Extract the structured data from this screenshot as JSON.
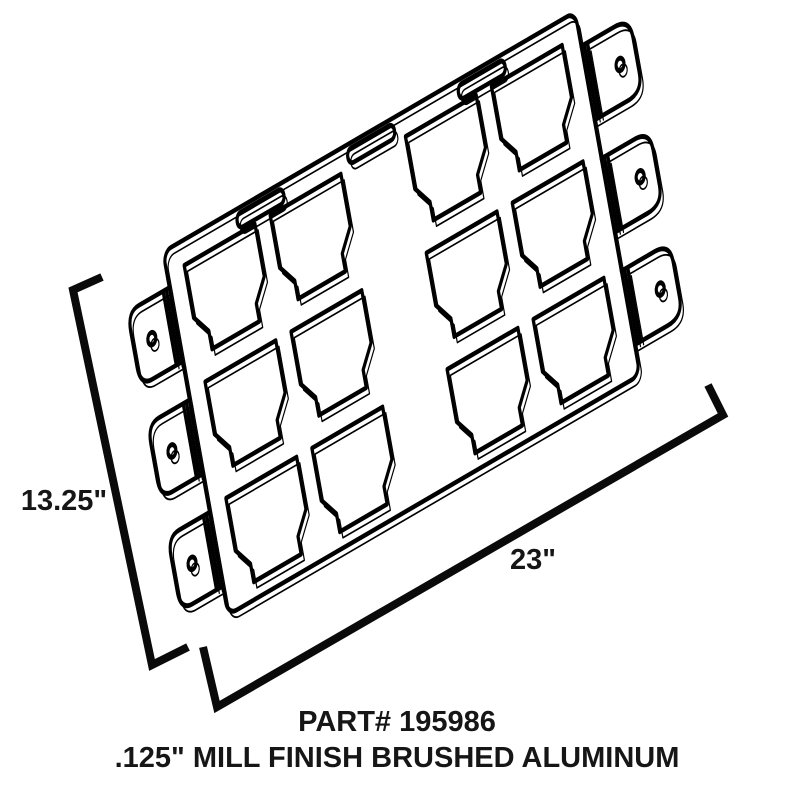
{
  "drawing": {
    "type": "technical-line-drawing",
    "part_label": "PART# 195986",
    "material_label": ".125\" MILL FINISH BRUSHED ALUMINUM",
    "dimensions": {
      "height_label": "13.25\"",
      "width_label": "23\""
    },
    "colors": {
      "background": "#ffffff",
      "line": "#000000",
      "text": "#161616"
    },
    "features": {
      "switch_cutouts": 12,
      "cutout_grid": "4 columns x 3 rows",
      "hang_slots": 3,
      "mounting_tabs_left": 3,
      "mounting_tabs_right": 3,
      "tab_holes": 6
    }
  }
}
